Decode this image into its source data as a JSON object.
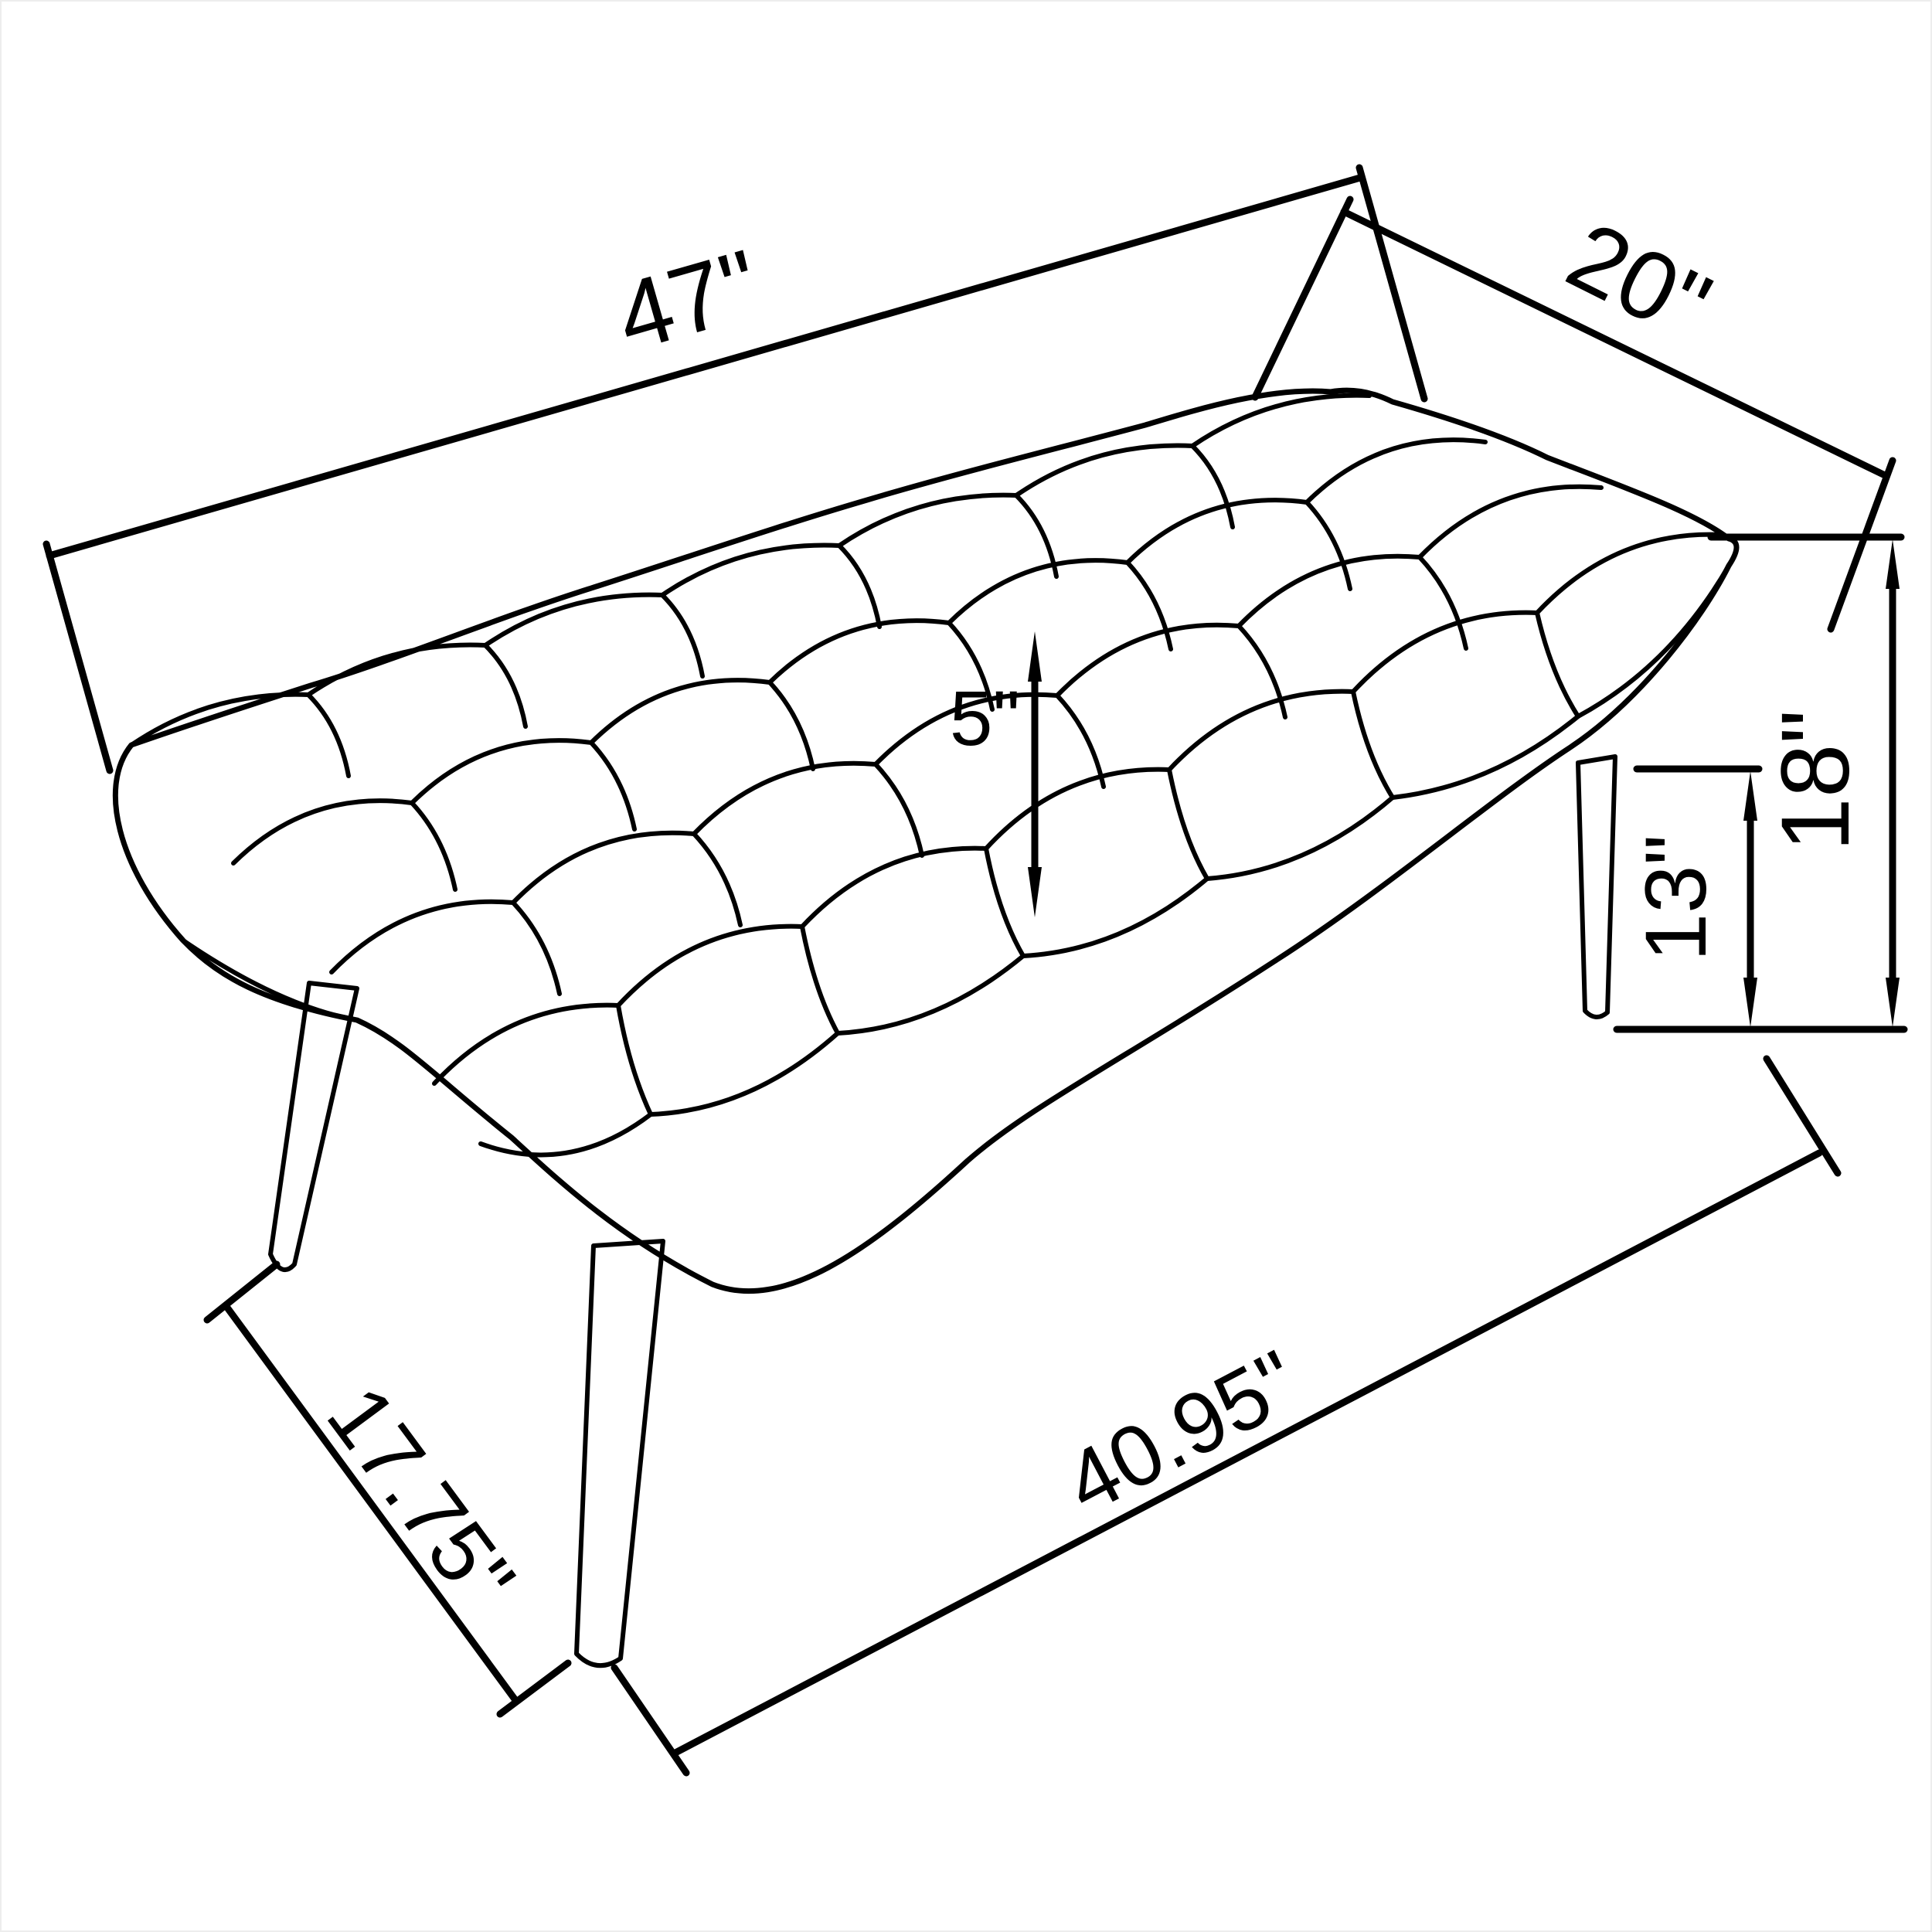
{
  "drawing": {
    "kind": "product-dimension-diagram",
    "subject": "button-tufted bench with splayed tapered legs",
    "background_color": "#ffffff",
    "line_color": "#000000"
  },
  "dims": {
    "overall_width": {
      "label": "47\"",
      "measures": "overall width along back edge of seat"
    },
    "overall_depth": {
      "label": "20\"",
      "measures": "seat depth along right edge"
    },
    "cushion_thickness": {
      "label": "5\"",
      "measures": "cushion thickness"
    },
    "leg_height": {
      "label": "13\"",
      "measures": "floor to underside of seat (leg height)"
    },
    "overall_height": {
      "label": "18\"",
      "measures": "floor to top of seat (overall height)"
    },
    "leg_span_side": {
      "label": "17.75\"",
      "measures": "front-left to front-right foot spacing (side)"
    },
    "leg_span_front": {
      "label": "40.95\"",
      "measures": "front foot to back foot spacing (front)"
    }
  }
}
